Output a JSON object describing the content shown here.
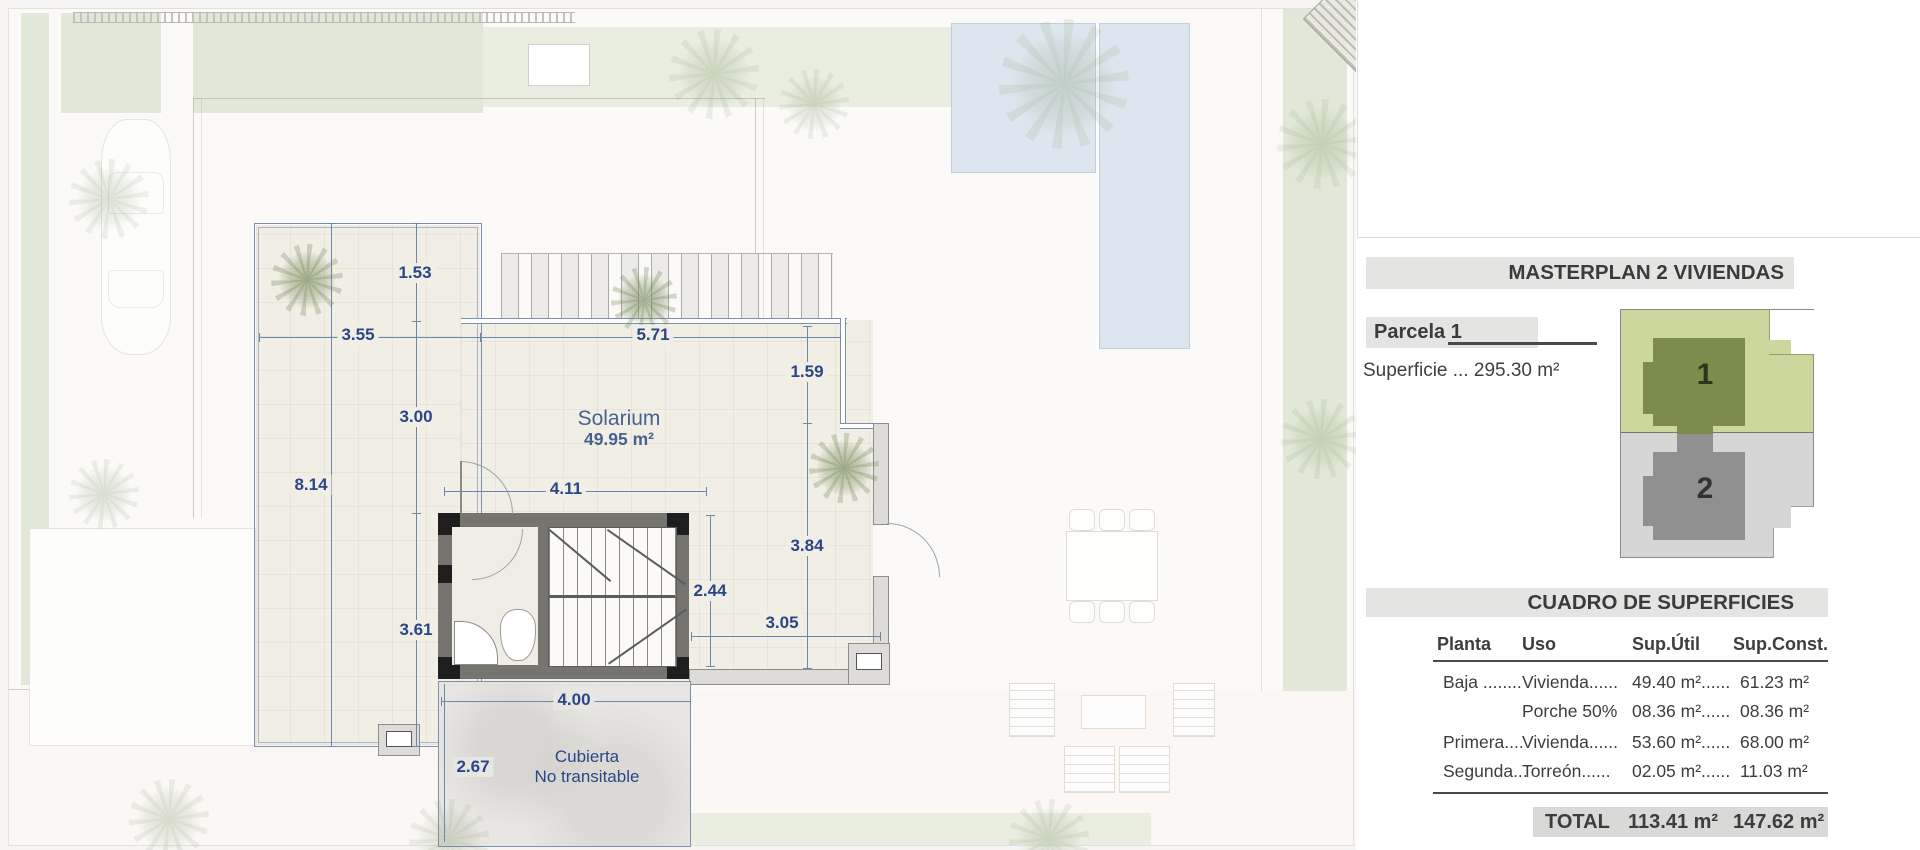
{
  "plan": {
    "solarium_label": "Solarium",
    "solarium_area": "49.95 m²",
    "cubierta_line1": "Cubierta",
    "cubierta_line2": "No transitable",
    "dims": {
      "v153": "1.53",
      "v355": "3.55",
      "v571": "5.71",
      "v159": "1.59",
      "v300": "3.00",
      "v814": "8.14",
      "v411": "4.11",
      "v384": "3.84",
      "v244": "2.44",
      "v305": "3.05",
      "v361": "3.61",
      "v400": "4.00",
      "v267": "2.67"
    }
  },
  "panel": {
    "masterplan_title": "MASTERPLAN 2 VIVIENDAS",
    "parcela_label": "Parcela 1",
    "superficie_text": "Superficie ... 295.30 m²",
    "map": {
      "parcel1_label": "1",
      "parcel2_label": "2"
    },
    "cuadro_title": "CUADRO DE SUPERFICIES",
    "table": {
      "headers": [
        "Planta",
        "Uso",
        "Sup.Útil",
        "Sup.Const."
      ],
      "rows": [
        [
          "Baja ........",
          "Vivienda......",
          "49.40 m²......",
          "61.23 m²"
        ],
        [
          "",
          "Porche 50%",
          "08.36 m²......",
          "08.36 m²"
        ],
        [
          "Primera....",
          "Vivienda......",
          "53.60 m²......",
          "68.00 m²"
        ],
        [
          "Segunda...",
          "Torreón......",
          "02.05 m²......",
          "11.03 m²"
        ]
      ],
      "total_label": "TOTAL",
      "total_util": "113.41 m²",
      "total_const": "147.62 m²"
    }
  },
  "colors": {
    "dimension_blue": "#2b4687",
    "grass_green": "#e1e8d7",
    "pool_blue": "#dde6ee",
    "parcel1_green": "#cbd79c",
    "parcel1_house": "#7c8c4d",
    "parcel2_gray": "#d6d6d6",
    "parcel2_house": "#909090",
    "header_bar_gray": "#e4e4e3",
    "total_bar_gray": "#d9d9d8"
  }
}
